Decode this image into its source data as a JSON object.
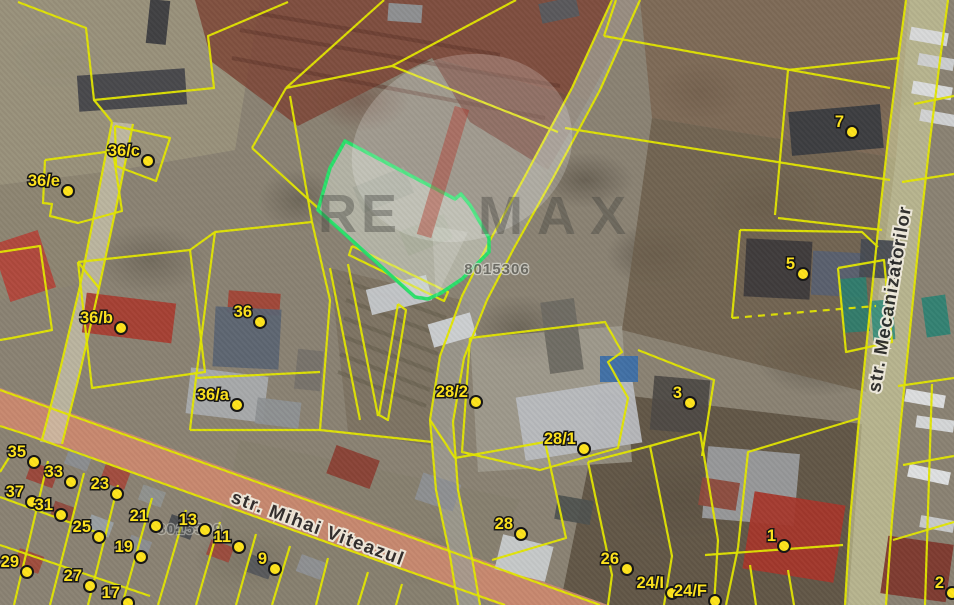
{
  "map": {
    "colors": {
      "base": "#8a8273",
      "parcel_line": "#e3e600",
      "label_fill": "#ffe41c",
      "label_outline": "#141414",
      "highlight_stroke": "#2ae06a",
      "highlight_fill": "rgba(225,242,230,0.30)",
      "road_red_overlay": "#bf4f33",
      "road_red_base": "#d8c3ae",
      "road_olive": "#d6d5a0",
      "track_gray": "#a09d92",
      "street_text": "#262626",
      "street_halo": "#f4efe2",
      "cadastral_fill": "#62625c",
      "cadastral_halo": "#d8d8d0",
      "watermark_letters": "#3f3f3b",
      "watermark_slash": "#b5372b"
    },
    "terrain": [
      {
        "points": "0,0 260,0 235,150 120,170 0,185",
        "fill": "#9a927c",
        "opacity": 0.9
      },
      {
        "points": "195,0 640,0 588,100 432,58 298,126 212,62",
        "fill": "#7d4536",
        "opacity": 0.85
      },
      {
        "points": "432,58 588,100 548,170 470,122",
        "fill": "#6f3c2f",
        "opacity": 0.75
      },
      {
        "points": "640,0 910,0 896,158 652,118",
        "fill": "#7a6450",
        "opacity": 0.8
      },
      {
        "points": "652,118 896,158 866,392 622,330",
        "fill": "#6d5f4c",
        "opacity": 0.85
      },
      {
        "points": "598,392 862,424 848,605 560,605 588,468",
        "fill": "#5d5243",
        "opacity": 0.9
      },
      {
        "points": "330,268 470,302 446,448 348,432",
        "fill": "#7b7260",
        "opacity": 0.85
      },
      {
        "points": "470,338 622,326 632,462 478,472",
        "fill": "#a7a295",
        "opacity": 0.7
      },
      {
        "points": "0,185 120,170 100,280 0,300",
        "fill": "#8e8672",
        "opacity": 0.75
      },
      {
        "points": "240,440 520,500 470,605 200,605",
        "fill": "#867e6d",
        "opacity": 0.6
      }
    ],
    "ground_lines": [
      {
        "points": "348,282 446,318",
        "color": "#5f5847"
      },
      {
        "points": "346,300 442,336",
        "color": "#5f5847"
      },
      {
        "points": "344,318 438,354",
        "color": "#5f5847"
      },
      {
        "points": "342,336 434,372",
        "color": "#5f5847"
      },
      {
        "points": "340,354 430,390",
        "color": "#5f5847"
      },
      {
        "points": "338,372 426,406",
        "color": "#5f5847"
      },
      {
        "points": "240,30 560,86",
        "color": "#5a3328"
      },
      {
        "points": "232,58 545,118",
        "color": "#5a3328"
      },
      {
        "points": "250,12 500,55",
        "color": "#5a3328"
      }
    ],
    "areas": [
      {
        "id": "road-mihai-viteazul-base",
        "points": "0,388 122,431 242,474 362,517 482,560 608,605 500,605 382,563 262,520 142,477 22,434 0,426",
        "fill": "#d8c3ae",
        "opacity": 0.9
      },
      {
        "id": "road-mihai-viteazul-overlay",
        "points": "0,388 122,431 242,474 362,517 482,560 608,605 500,605 382,563 262,520 142,477 22,434 0,426",
        "fill": "#bf4f33",
        "opacity": 0.48
      },
      {
        "id": "road-mecanizatorilor",
        "points": "906,0 948,0 940,60 930,140 920,230 910,330 900,430 892,520 886,605 845,605 850,520 858,430 868,330 878,230 888,140 898,60",
        "fill": "#d6d5a0",
        "opacity": 0.6
      },
      {
        "id": "track-center",
        "points": "612,0 640,0 600,90 552,180 514,248 487,300 464,358 453,422 458,490 472,558 480,605 458,605 450,556 436,490 430,420 440,356 462,296 488,244 524,178 572,88",
        "fill": "#a09d92",
        "opacity": 0.8
      },
      {
        "id": "lane-northwest",
        "points": "112,122 133,124 116,208 99,288 80,372 62,444 40,442 60,370 80,286 96,205",
        "fill": "#cec9b2",
        "opacity": 0.7
      }
    ],
    "parcel_lines": [
      "18,2 86,28 94,100 214,88 208,36 288,2",
      "94,100 112,122",
      "112,122 96,205 80,286 60,370 42,440",
      "133,124 116,208 99,288 80,372 62,444",
      "115,126 170,138 156,181 116,166 115,126",
      "45,160 113,151 122,211 78,223 50,216 52,204 43,203 45,160",
      "0,252 40,246 52,330 12,338 0,340",
      "78,262 190,250 205,372 92,388 78,262",
      "99,288 78,262",
      "190,250 215,232 312,222",
      "215,232 196,378 190,430",
      "312,222 330,300 320,430",
      "196,378 320,372",
      "190,430 320,430",
      "290,96 312,222",
      "286,88 392,66 558,132",
      "384,0 286,88",
      "516,0 392,66",
      "252,148 318,208",
      "252,148 286,88",
      "352,246 448,292 444,301 349,255 352,246",
      "398,304 406,310 388,420 379,415 398,304",
      "330,268 360,420",
      "348,264 378,416",
      "320,430 432,442",
      "612,0 572,88 524,178 488,244 462,296 440,356 430,420 436,490 450,556 458,605",
      "640,0 600,90 552,180 514,248 487,300 464,358 453,422 458,490 472,558 480,605",
      "565,128 890,180",
      "604,36 890,88",
      "604,36 616,0",
      "788,70 900,58",
      "788,70 775,215",
      "778,218 882,230",
      "740,230 862,232 878,247",
      "740,230 732,318",
      {
        "points": "732,318 876,306",
        "dash": "7,6"
      },
      "638,350 714,380 702,456",
      "860,418 748,452 738,548",
      "738,548 726,605",
      "705,555 843,545",
      "588,462 650,446 700,432",
      "650,446 672,556 664,605",
      "700,432 718,540 714,605",
      "588,462 612,575 608,605",
      "750,565 756,605",
      "788,570 794,605",
      "470,338 605,322 622,352 608,362 628,398 618,448 540,470 462,452 470,338",
      "455,458 545,442 566,538 492,560",
      "430,420 455,458",
      "914,104 954,96",
      "902,182 954,174",
      "838,268 884,260 892,342 846,352 838,268",
      "898,386 954,378",
      "903,465 954,456",
      "932,384 925,605",
      "893,540 954,522",
      "15,448 0,472",
      "48,461 14,605",
      "84,473 50,605",
      "118,485 88,605",
      "152,498 122,605",
      "186,510 158,605",
      "220,522 196,605",
      "256,534 236,605",
      "290,546 272,605",
      "328,558 316,605",
      "368,572 358,605",
      "402,584 396,605",
      "0,497 96,532",
      "0,545 150,596",
      "0,390 120,433 240,476 360,519 480,562 600,605",
      "0,426 25,434 145,477 265,520 385,563 505,605",
      "906,0 898,60 888,140 878,230 868,330 858,430 850,520 845,605",
      "948,0 940,60 930,140 920,230 910,330 900,430 892,520 886,605"
    ],
    "buildings": [
      [
        78,
        72,
        108,
        36,
        -4,
        "#45464a"
      ],
      [
        148,
        0,
        20,
        44,
        6,
        "#3c3d40"
      ],
      [
        388,
        4,
        34,
        18,
        4,
        "#8f9296"
      ],
      [
        540,
        0,
        38,
        20,
        -12,
        "#595a5e"
      ],
      [
        0,
        236,
        48,
        60,
        -18,
        "#b2463a"
      ],
      [
        84,
        298,
        90,
        40,
        7,
        "#a83d30"
      ],
      [
        228,
        292,
        52,
        22,
        4,
        "#a24436"
      ],
      [
        214,
        308,
        66,
        60,
        3,
        "#5c6472"
      ],
      [
        296,
        350,
        26,
        40,
        6,
        "#77726a"
      ],
      [
        188,
        372,
        78,
        46,
        7,
        "#a9abad"
      ],
      [
        256,
        400,
        44,
        26,
        7,
        "#8e9194"
      ],
      [
        356,
        176,
        55,
        28,
        -22,
        "#8f8a7d"
      ],
      [
        402,
        222,
        48,
        26,
        -22,
        "#96927f"
      ],
      [
        368,
        282,
        62,
        26,
        -14,
        "#c6c9cc"
      ],
      [
        430,
        318,
        44,
        24,
        -16,
        "#cfd2d5"
      ],
      [
        520,
        388,
        118,
        64,
        -9,
        "#b9bcc0"
      ],
      [
        545,
        300,
        34,
        72,
        -8,
        "#6e6a62"
      ],
      [
        652,
        378,
        56,
        54,
        5,
        "#4e4a46"
      ],
      [
        600,
        356,
        38,
        26,
        0,
        "#3d6fa8"
      ],
      [
        745,
        240,
        66,
        58,
        3,
        "#3d3a3b"
      ],
      [
        812,
        252,
        52,
        44,
        3,
        "#586070"
      ],
      [
        860,
        240,
        38,
        38,
        3,
        "#474b52"
      ],
      [
        790,
        108,
        92,
        44,
        -5,
        "#3a3c40"
      ],
      [
        705,
        450,
        92,
        72,
        5,
        "#9a9c9e"
      ],
      [
        748,
        498,
        92,
        78,
        9,
        "#a5372b"
      ],
      [
        700,
        480,
        38,
        28,
        9,
        "#8c4a3c"
      ],
      [
        905,
        392,
        40,
        13,
        10,
        "#e0e2e4"
      ],
      [
        916,
        418,
        38,
        12,
        8,
        "#d8dadc"
      ],
      [
        908,
        468,
        42,
        13,
        12,
        "#e3e5e7"
      ],
      [
        920,
        518,
        34,
        12,
        10,
        "#cbcdcf"
      ],
      [
        910,
        30,
        38,
        13,
        10,
        "#d9dbdd"
      ],
      [
        918,
        56,
        36,
        12,
        10,
        "#cfd1d3"
      ],
      [
        912,
        84,
        40,
        13,
        10,
        "#dcdee0"
      ],
      [
        920,
        112,
        36,
        12,
        10,
        "#d3d5d7"
      ],
      [
        842,
        278,
        26,
        54,
        -4,
        "#2f7d6d"
      ],
      [
        872,
        300,
        22,
        40,
        -4,
        "#3a8f7c"
      ],
      [
        924,
        296,
        24,
        40,
        -8,
        "#2f8273"
      ],
      [
        884,
        540,
        66,
        58,
        8,
        "#7e382d"
      ],
      [
        28,
        466,
        28,
        18,
        20,
        "#9c4438"
      ],
      [
        66,
        452,
        24,
        16,
        20,
        "#8b8d90"
      ],
      [
        102,
        468,
        26,
        18,
        20,
        "#a34a3c"
      ],
      [
        140,
        488,
        24,
        16,
        20,
        "#90928f"
      ],
      [
        52,
        504,
        22,
        16,
        20,
        "#8f4a3e"
      ],
      [
        88,
        518,
        24,
        16,
        20,
        "#9aa0a4"
      ],
      [
        16,
        552,
        26,
        18,
        20,
        "#a04a3a"
      ],
      [
        128,
        538,
        22,
        16,
        20,
        "#8c8e91"
      ],
      [
        168,
        518,
        26,
        18,
        20,
        "#4a4c50"
      ],
      [
        208,
        543,
        24,
        16,
        20,
        "#9c4a3c"
      ],
      [
        248,
        558,
        24,
        18,
        20,
        "#55575b"
      ],
      [
        298,
        558,
        26,
        18,
        20,
        "#8e9093"
      ],
      [
        330,
        452,
        46,
        30,
        20,
        "#8a4034"
      ],
      [
        418,
        478,
        40,
        28,
        18,
        "#8d8f92"
      ],
      [
        498,
        540,
        52,
        36,
        14,
        "#c9cccd"
      ],
      [
        556,
        498,
        36,
        24,
        10,
        "#4f524f"
      ]
    ],
    "highlight_parcel": {
      "points": "345,141 455,199 461,194 470,205 489,238 489,252 462,279 441,293 428,299 415,297 318,210 330,168",
      "inner_fill": "#b3ab9c"
    },
    "watermark": {
      "brand_left": "RE",
      "brand_right": "MAX",
      "balloon": {
        "cx": 462,
        "cy": 148,
        "rx": 112,
        "ry": 92,
        "rotate": -18
      },
      "tail_points": "432,226 468,232 436,298",
      "left_pos": {
        "x": 318,
        "y": 232
      },
      "right_pos": {
        "x": 478,
        "y": 234
      },
      "slash": {
        "x1": 462,
        "y1": 108,
        "x2": 424,
        "y2": 236
      }
    },
    "cadastral_refs": [
      {
        "text": "8015306",
        "x": 497,
        "y": 274,
        "opacity": 0.8
      },
      {
        "text": "8015309",
        "x": 190,
        "y": 534,
        "opacity": 0.5
      }
    ],
    "street_labels": [
      {
        "id": "mihai-viteazul",
        "name": "str. Mihai Viteazul",
        "x": 230,
        "y": 502,
        "rotate": 20.3,
        "size": 18.5,
        "spacing": 1.5
      },
      {
        "id": "mecanizatorilor",
        "name": "str. Mecanizatorilor",
        "x": 880,
        "y": 393,
        "rotate": -80.5,
        "size": 18.5,
        "spacing": 1
      }
    ],
    "parcel_labels": [
      {
        "text": "36/c",
        "x": 148,
        "y": 161
      },
      {
        "text": "36/e",
        "x": 68,
        "y": 191
      },
      {
        "text": "36/b",
        "x": 121,
        "y": 328
      },
      {
        "text": "36",
        "x": 260,
        "y": 322
      },
      {
        "text": "36/a",
        "x": 237,
        "y": 405
      },
      {
        "text": "28/2",
        "x": 476,
        "y": 402
      },
      {
        "text": "28/1",
        "x": 584,
        "y": 449
      },
      {
        "text": "28",
        "x": 521,
        "y": 534
      },
      {
        "text": "26",
        "x": 627,
        "y": 569
      },
      {
        "text": "24/I",
        "x": 672,
        "y": 593
      },
      {
        "text": "24/F",
        "x": 715,
        "y": 601
      },
      {
        "text": "7",
        "x": 852,
        "y": 132
      },
      {
        "text": "5",
        "x": 803,
        "y": 274
      },
      {
        "text": "3",
        "x": 690,
        "y": 403
      },
      {
        "text": "1",
        "x": 784,
        "y": 546
      },
      {
        "text": "2",
        "x": 952,
        "y": 593
      },
      {
        "text": "35",
        "x": 34,
        "y": 462
      },
      {
        "text": "33",
        "x": 71,
        "y": 482
      },
      {
        "text": "23",
        "x": 117,
        "y": 494
      },
      {
        "text": "37",
        "x": 32,
        "y": 502
      },
      {
        "text": "31",
        "x": 61,
        "y": 515
      },
      {
        "text": "25",
        "x": 99,
        "y": 537
      },
      {
        "text": "21",
        "x": 156,
        "y": 526
      },
      {
        "text": "13",
        "x": 205,
        "y": 530
      },
      {
        "text": "11",
        "x": 239,
        "y": 547
      },
      {
        "text": "19",
        "x": 141,
        "y": 557
      },
      {
        "text": "9",
        "x": 275,
        "y": 569
      },
      {
        "text": "29",
        "x": 27,
        "y": 572
      },
      {
        "text": "27",
        "x": 90,
        "y": 586
      },
      {
        "text": "17",
        "x": 128,
        "y": 603
      }
    ]
  }
}
